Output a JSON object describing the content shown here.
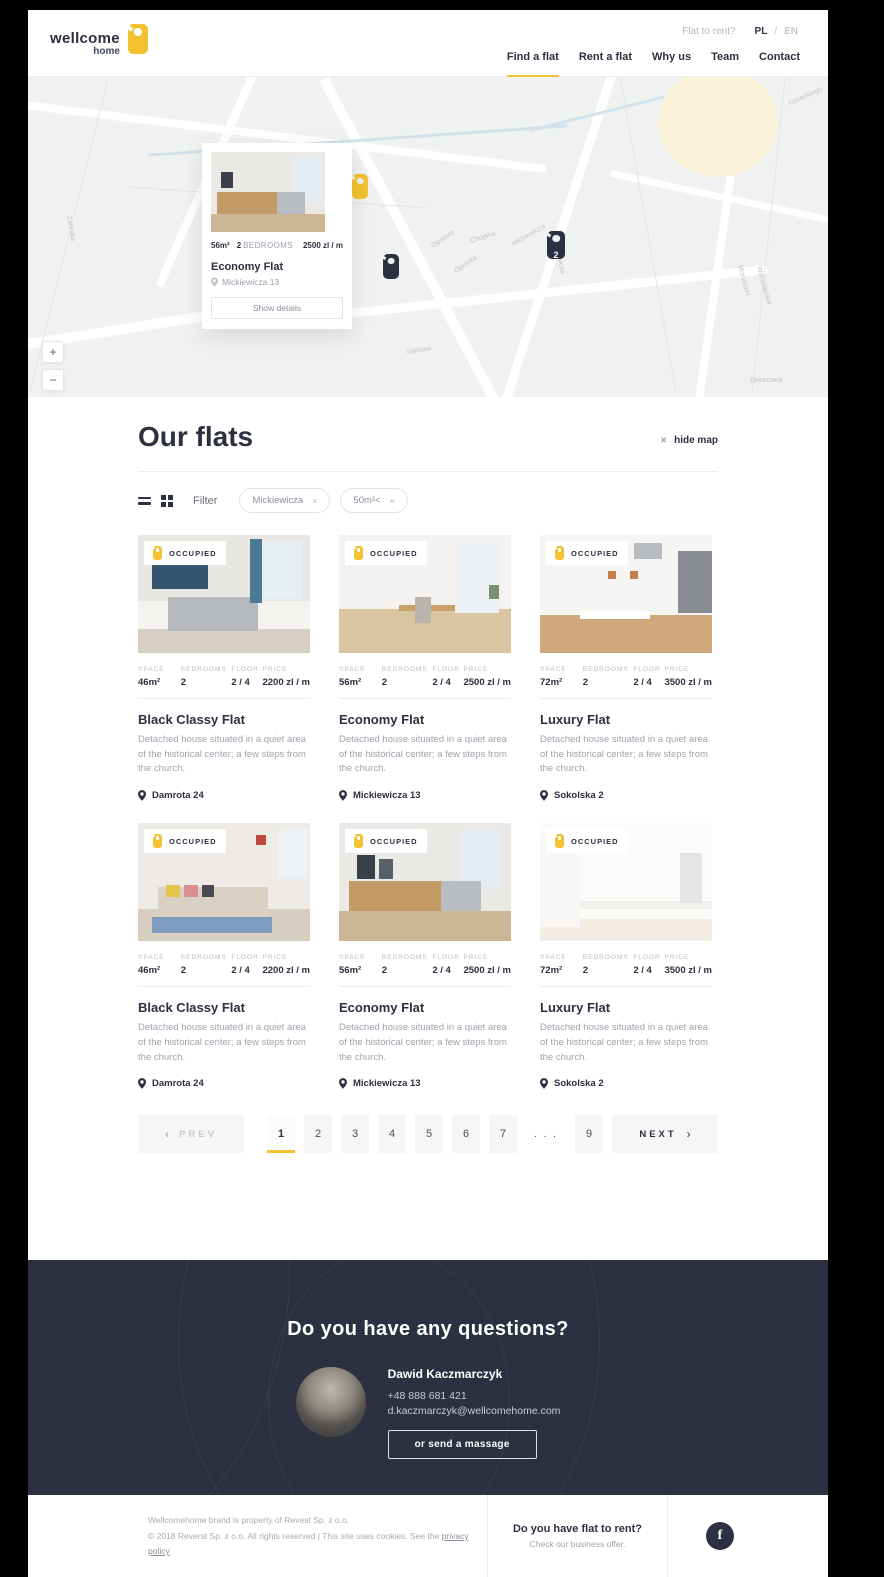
{
  "colors": {
    "accent": "#f2c230",
    "dark": "#2d3040"
  },
  "brand": {
    "top": "wellcome",
    "bottom": "home"
  },
  "header": {
    "flat_to_rent": "Flat to rent?",
    "lang_pl": "PL",
    "lang_sep": "/",
    "lang_en": "EN",
    "nav": [
      {
        "label": "Find a flat",
        "active": true
      },
      {
        "label": "Rent a flat",
        "active": false
      },
      {
        "label": "Why us",
        "active": false
      },
      {
        "label": "Team",
        "active": false
      },
      {
        "label": "Contact",
        "active": false
      }
    ]
  },
  "map": {
    "zoom_in": "+",
    "zoom_out": "−",
    "marker_count": "2",
    "street_labels": [
      "Opolska",
      "Opolska",
      "Chopina",
      "Mickiewicza",
      "Mickiewicza",
      "Sądowa",
      "Warszawska",
      "Moniuszki",
      "Dworcowa",
      "Góreckiego",
      "Zabrska"
    ],
    "popup": {
      "space": "56m²",
      "bedrooms_count": "2",
      "bedrooms_label": "BEDROOMS",
      "price": "2500 zl / m",
      "title": "Economy Flat",
      "address": "Mickiewicza 13",
      "button": "Show details"
    }
  },
  "main": {
    "title": "Our flats",
    "hide_map_icon": "×",
    "hide_map": "hide map",
    "filter_label": "Filter",
    "chip_remove": "×",
    "chips": [
      {
        "label": "Mickiewicza"
      },
      {
        "label": "50m²<"
      }
    ],
    "stats_headers": [
      "SPACE",
      "BEDROOMS",
      "FLOOR",
      "PRICE"
    ],
    "occupied_label": "OCCUPIED",
    "cards": [
      {
        "space": "46m²",
        "bedrooms": "2",
        "floor": "2 / 4",
        "price": "2200 zl / m",
        "title": "Black Classy Flat",
        "desc": "Detached house situated in a quiet area of the historical center; a few steps from the church.",
        "address": "Damrota 24",
        "occupied": false
      },
      {
        "space": "56m²",
        "bedrooms": "2",
        "floor": "2 / 4",
        "price": "2500 zl / m",
        "title": "Economy Flat",
        "desc": "Detached house situated in a quiet area of the historical center; a few steps from the church.",
        "address": "Mickiewicza 13",
        "occupied": false
      },
      {
        "space": "72m²",
        "bedrooms": "2",
        "floor": "2 / 4",
        "price": "3500 zl / m",
        "title": "Luxury Flat",
        "desc": "Detached house situated in a quiet area of the historical center; a few steps from the church.",
        "address": "Sokolska 2",
        "occupied": false
      },
      {
        "space": "46m²",
        "bedrooms": "2",
        "floor": "2 / 4",
        "price": "2200 zl / m",
        "title": "Black Classy Flat",
        "desc": "Detached house situated in a quiet area of the historical center; a few steps from the church.",
        "address": "Damrota 24",
        "occupied": false
      },
      {
        "space": "56m²",
        "bedrooms": "2",
        "floor": "2 / 4",
        "price": "2500 zl / m",
        "title": "Economy Flat",
        "desc": "Detached house situated in a quiet area of the historical center; a few steps from the church.",
        "address": "Mickiewicza 13",
        "occupied": false
      },
      {
        "space": "72m²",
        "bedrooms": "2",
        "floor": "2 / 4",
        "price": "3500 zl / m",
        "title": "Luxury Flat",
        "desc": "Detached house situated in a quiet area of the historical center; a few steps from the church.",
        "address": "Sokolska 2",
        "occupied": true
      }
    ],
    "pagination": {
      "prev_arrow": "‹",
      "prev": "PREV",
      "pages": [
        "1",
        "2",
        "3",
        "4",
        "5",
        "6",
        "7",
        ". . .",
        "9"
      ],
      "active": "1",
      "next": "NEXT",
      "next_arrow": "›"
    }
  },
  "cta": {
    "title": "Do you have any questions?",
    "name": "Dawid Kaczmarczyk",
    "phone": "+48 888 681 421",
    "email": "d.kaczmarczyk@wellcomehome.com",
    "button": "or send a massage"
  },
  "footer": {
    "line1": "Wellcomehome brand is property of Revest Sp. z o.o.",
    "line2": "© 2018 Reverst Sp. z o.o. All rights reserved  |  This site uses cookies. See the ",
    "privacy": "privacy policy",
    "rent_q": "Do you have flat to rent?",
    "rent_sub": "Check our business offer.",
    "fb": "f"
  }
}
